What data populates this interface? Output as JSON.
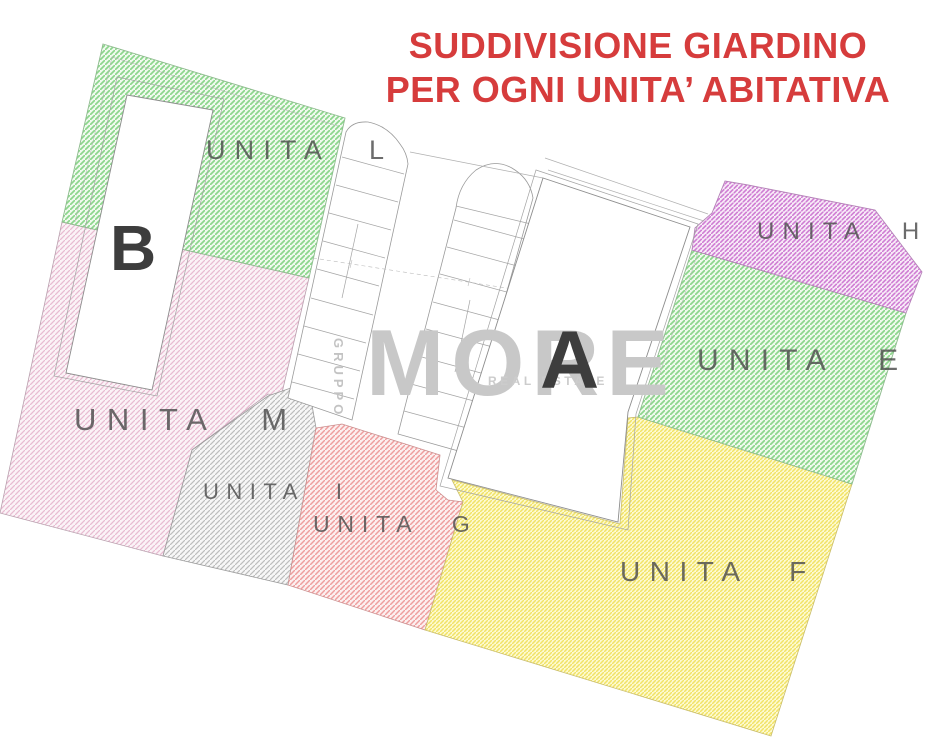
{
  "title": {
    "line1": "SUDDIVISIONE GIARDINO",
    "line2": "PER OGNI UNITA’ ABITATIVA",
    "color": "#d63c3c"
  },
  "watermark": {
    "vertical": "GRUPPO",
    "main": "MORE",
    "sub": "REAL ESTATE",
    "color": "#c8c8c8"
  },
  "buildings": [
    {
      "id": "A",
      "label": "A"
    },
    {
      "id": "B",
      "label": "B"
    }
  ],
  "regions": [
    {
      "id": "unita-l",
      "label": "UNITA L",
      "color": "#8cd68c",
      "tint": "#f0faee"
    },
    {
      "id": "unita-m",
      "label": "UNITA M",
      "color": "#e8bcd2",
      "tint": "#fbf3f7"
    },
    {
      "id": "unita-i",
      "label": "UNITA I",
      "color": "#bdbdbd",
      "tint": "#f7f7f7"
    },
    {
      "id": "unita-g",
      "label": "UNITA G",
      "color": "#ee9e9e",
      "tint": "#fcefef"
    },
    {
      "id": "unita-f",
      "label": "UNITA F",
      "color": "#f1e266",
      "tint": "#fdfacf"
    },
    {
      "id": "unita-e",
      "label": "UNITA E",
      "color": "#8cd68c",
      "tint": "#effaec"
    },
    {
      "id": "unita-h",
      "label": "UNITA H",
      "color": "#cf7dd3",
      "tint": "#f8ecf8"
    }
  ]
}
